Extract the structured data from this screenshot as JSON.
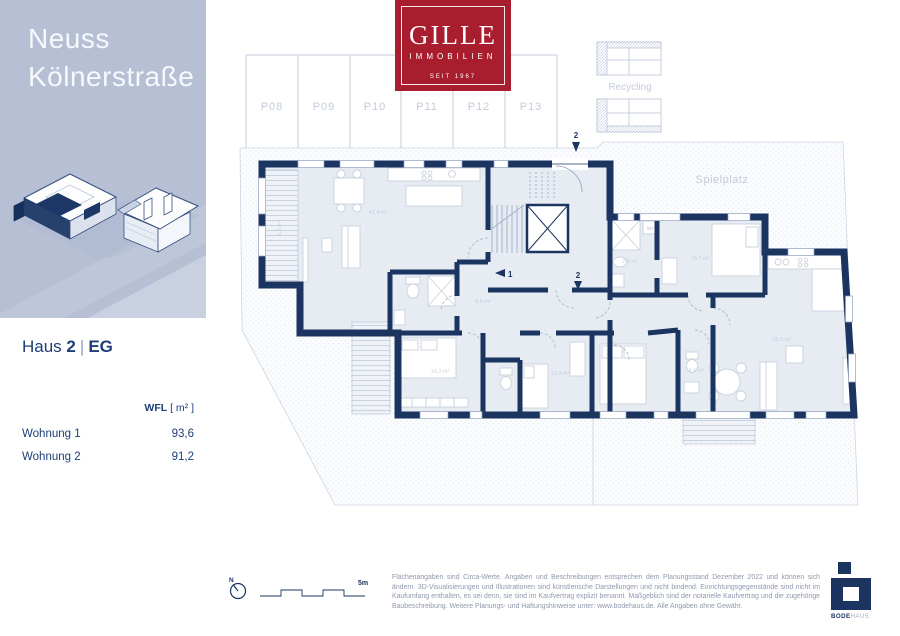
{
  "sidebar": {
    "title_line1": "Neuss",
    "title_line2": "Kölnerstraße"
  },
  "logo": {
    "name": "GILLE",
    "subtitle": "IMMOBILIEN",
    "since": "SEIT 1967"
  },
  "project": {
    "haus": "Haus",
    "number": "2",
    "separator": "|",
    "floor": "EG"
  },
  "table": {
    "header_label": "WFL",
    "header_unit": "[ m² ]",
    "rows": [
      {
        "label": "Wohnung 1",
        "value": "93,6"
      },
      {
        "label": "Wohnung 2",
        "value": "91,2"
      }
    ]
  },
  "site_plan": {
    "parking_spaces": [
      "P08",
      "P09",
      "P10",
      "P11",
      "P12",
      "P13"
    ],
    "recycling_label": "Recycling",
    "playground_label": "Spielplatz",
    "marker_1": "1",
    "marker_2": "2",
    "room_labels": [
      "41,4 m²",
      "14,2 m²",
      "12,4 m²",
      "15,7 m²",
      "36,5 m²",
      "6,1 m²",
      "8,6 m²",
      "4,4 m²",
      "2,4 m²",
      "WT"
    ]
  },
  "scale": {
    "north_label": "N",
    "length_label": "5m"
  },
  "footer": {
    "disclaimer": "Flächenangaben sind Circa-Werte. Angaben und Beschreibungen entsprechen dem Planungsstand Dezember 2022 und können sich ändern. 3D-Visualisierungen und Illustrationen sind künstlerische Darstellungen und nicht bindend. Einrichtungsgegenstände sind nicht im Kaufumfang enthalten, es sei denn, sie sind im Kaufvertrag explizit benannt. Maßgeblich sind der notarielle Kaufvertrag und die zugehörige Baubeschreibung. Weitere Planungs- und Haftungshinweise unter: www.bodehaus.de. Alle Angaben ohne Gewähr."
  },
  "brand": {
    "bode": "BODE",
    "haus": "HAUS"
  },
  "colors": {
    "navy": "#1b3560",
    "sidebar": "#b6bfd4",
    "logo_red": "#a81e2e",
    "room_fill": "#e7ecf3",
    "faint_line": "#c3cbdc"
  }
}
